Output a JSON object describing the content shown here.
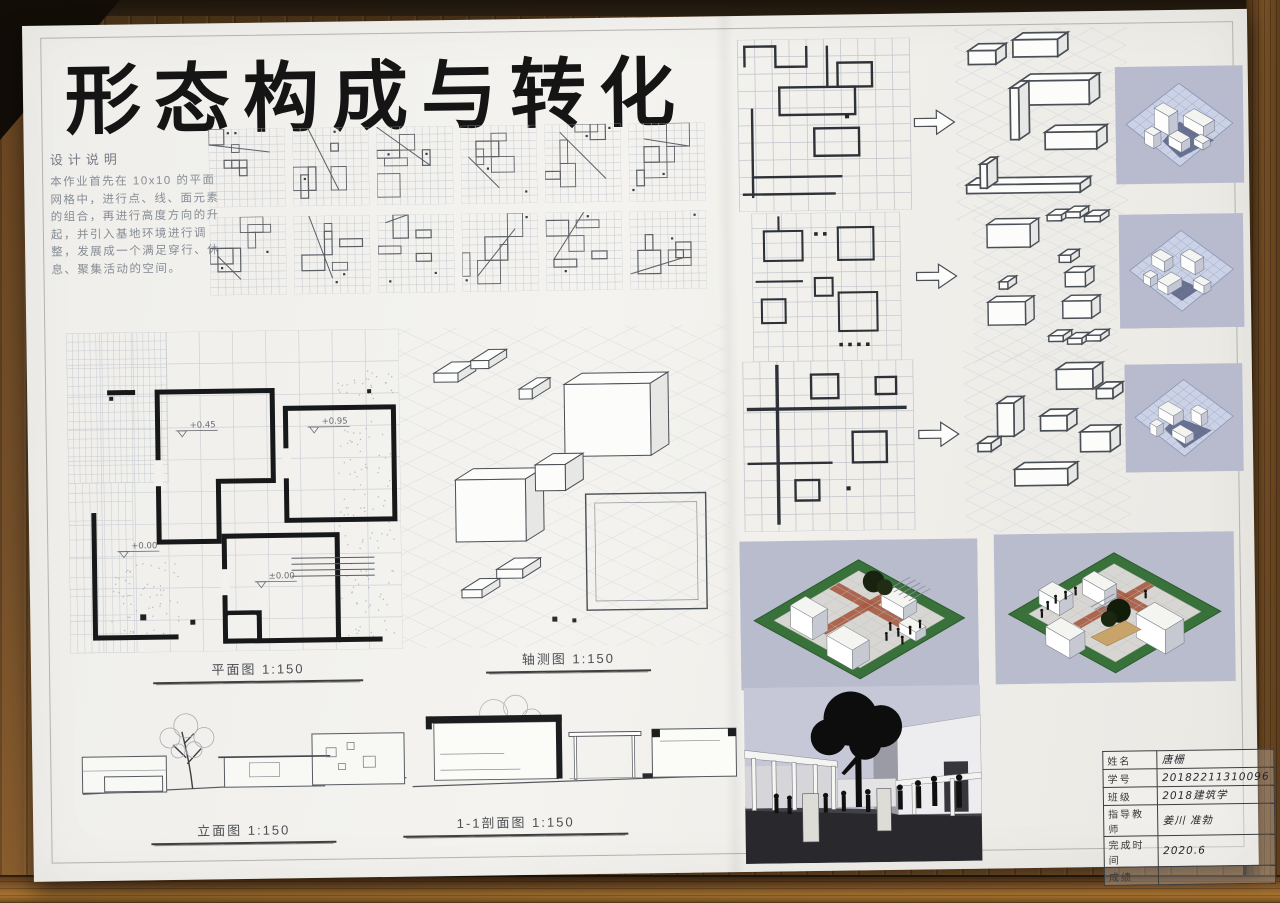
{
  "board": {
    "title": "形态构成与转化",
    "design_notes": {
      "heading": "设计说明",
      "body": "本作业首先在 10x10 的平面网格中，进行点、线、面元素的组合，再进行高度方向的升起，并引入基地环境进行调整，发展成一个满足穿行、休息、聚集活动的空间。"
    },
    "drawing_labels": {
      "plan": "平面图 1:150",
      "axonometric": "轴测图 1:150",
      "elevation": "立面图 1:150",
      "section": "1-1剖面图 1:150"
    },
    "plan_levels": [
      "+0.45",
      "+0.95",
      "±0.00",
      "+0.00"
    ],
    "title_block": {
      "rows": [
        {
          "label": "姓名",
          "value": "唐栅"
        },
        {
          "label": "学号",
          "value": "20182211310096"
        },
        {
          "label": "班级",
          "value": "2018建筑学"
        },
        {
          "label": "指导教师",
          "value": "姜川 准勃"
        },
        {
          "label": "完成时间",
          "value": "2020.6"
        },
        {
          "label": "成绩",
          "value": ""
        }
      ]
    },
    "colors": {
      "board_bg": "#f2f1ed",
      "wood": "#75502a",
      "grid_line": "#c2c6cd",
      "ink": "#2f343b",
      "render_bg": "#b8bbcd",
      "grass": "#39713a",
      "brick": "#a75a41"
    }
  }
}
